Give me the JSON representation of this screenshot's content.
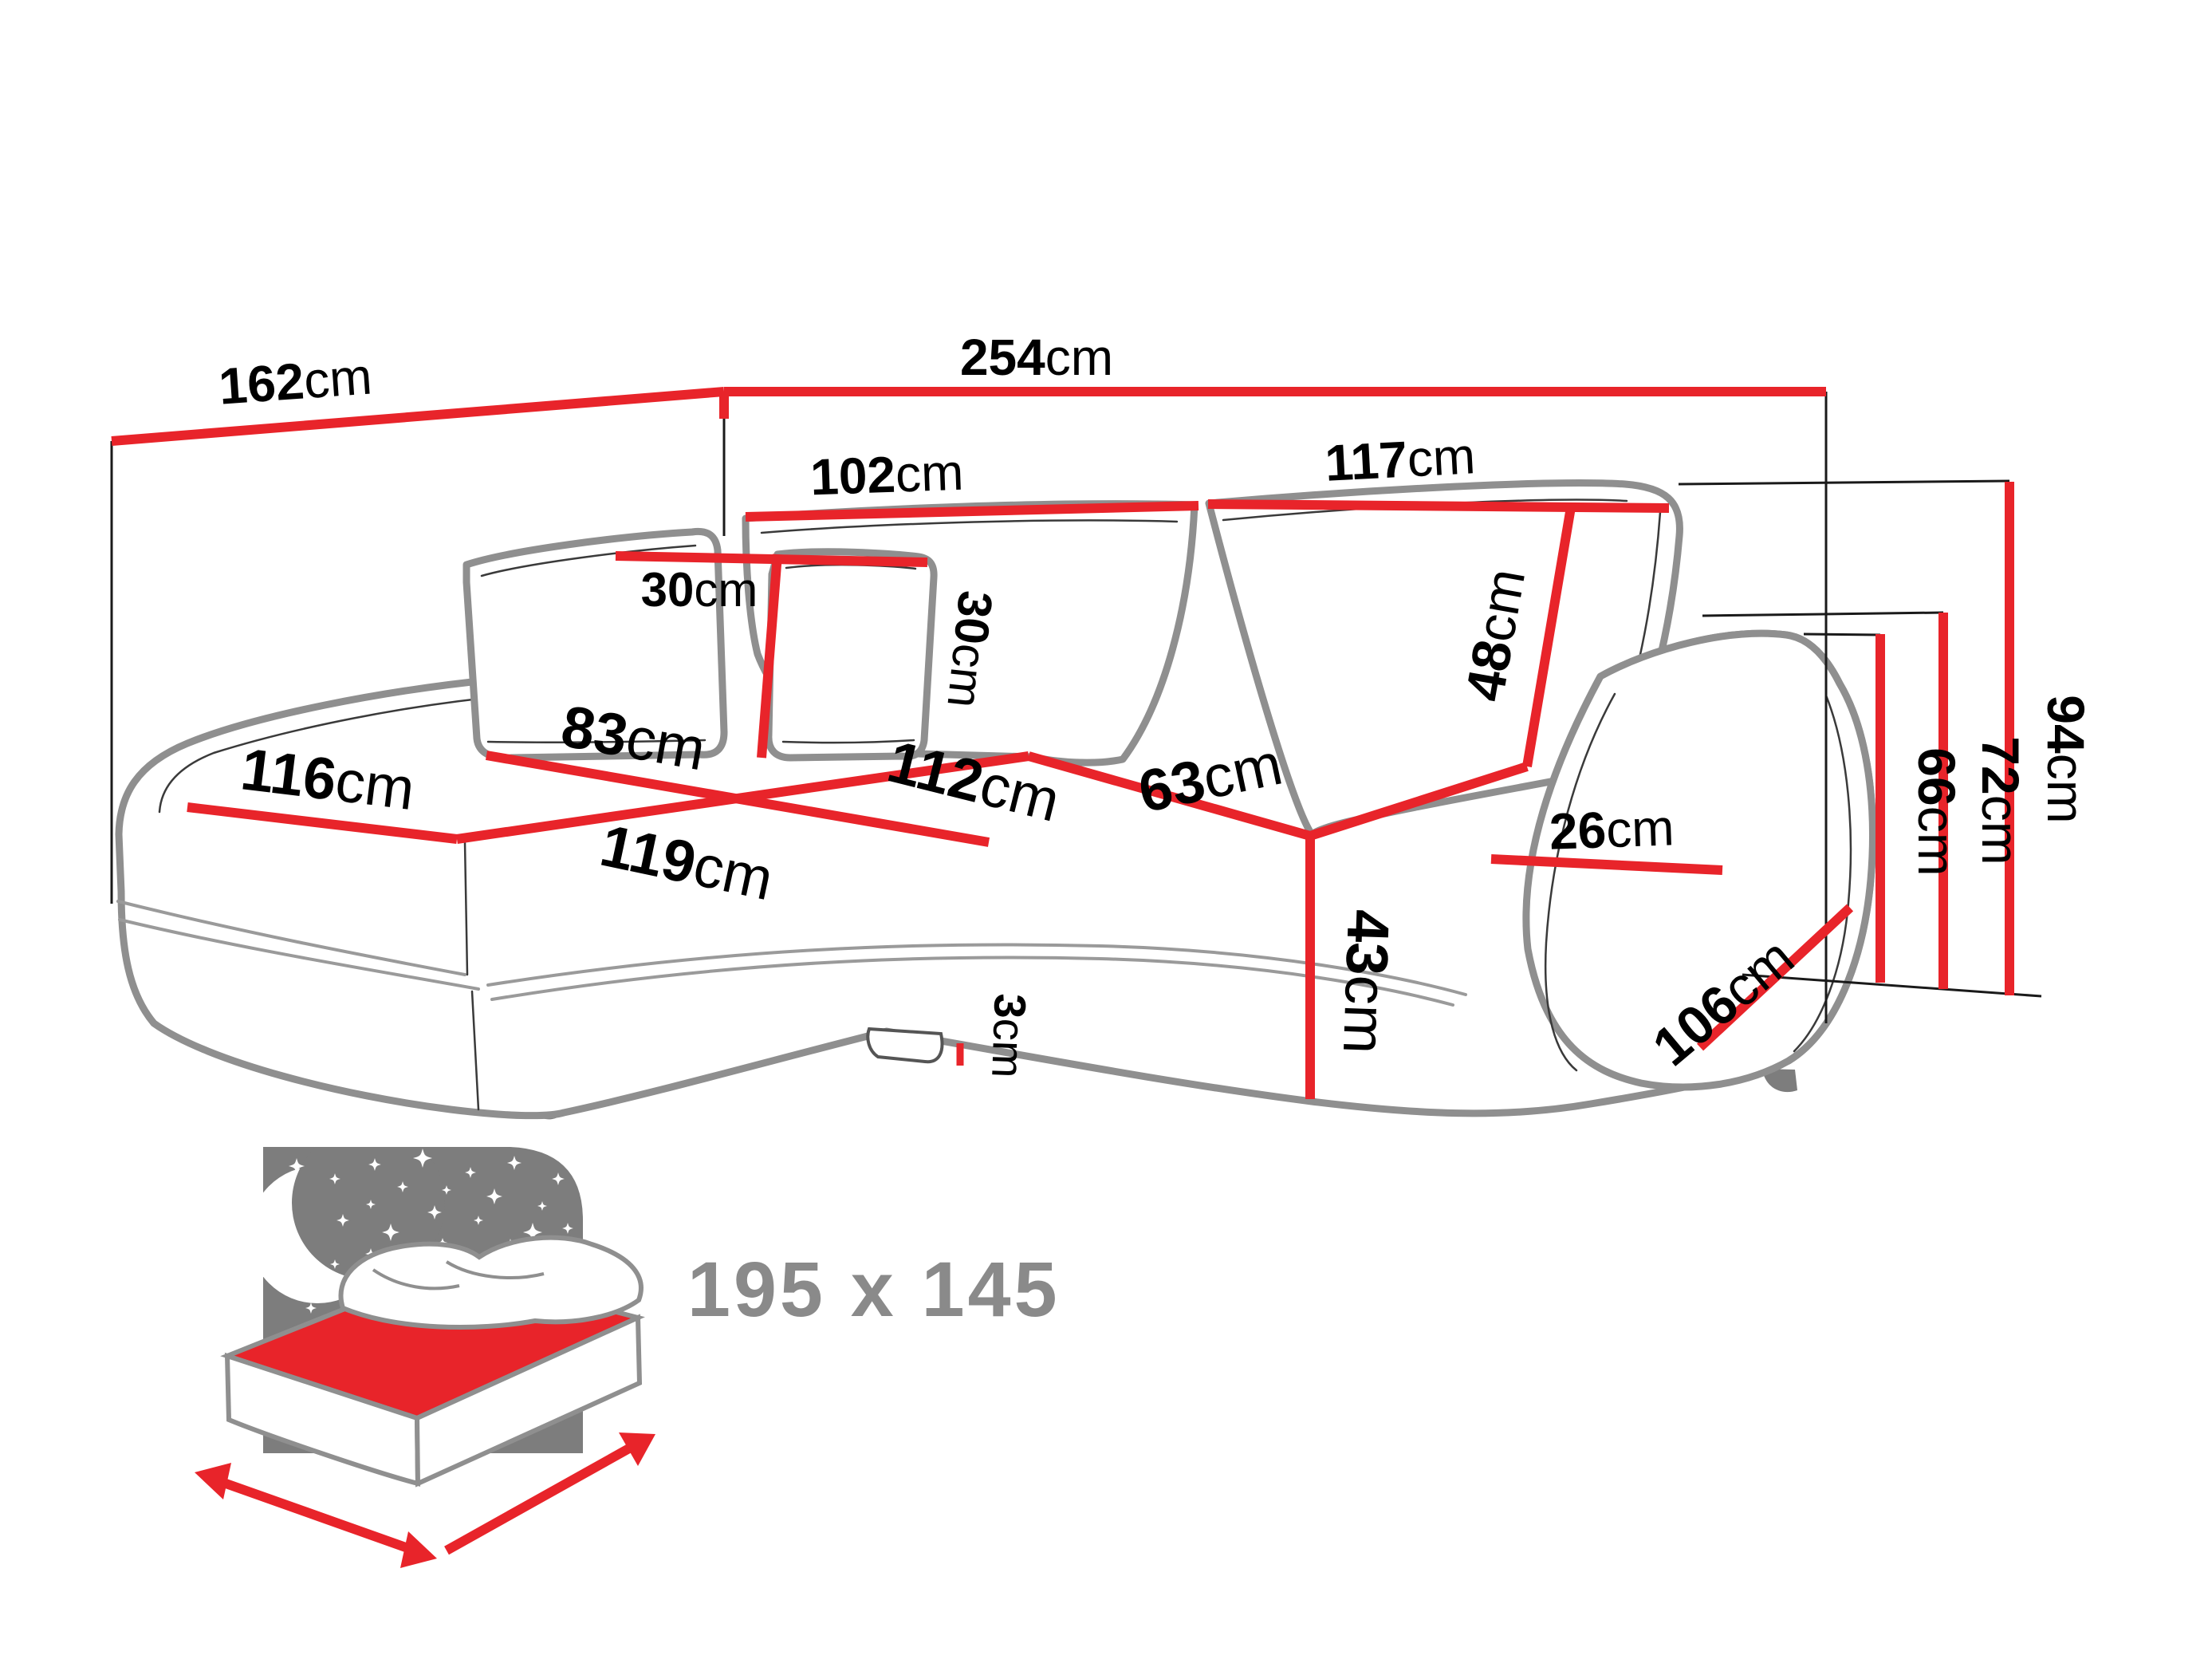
{
  "dimensions": {
    "wall_left": {
      "value": "162",
      "unit": "cm"
    },
    "wall_top": {
      "value": "254",
      "unit": "cm"
    },
    "backrest_left": {
      "value": "102",
      "unit": "cm"
    },
    "backrest_right": {
      "value": "117",
      "unit": "cm"
    },
    "pillow_width": {
      "value": "30",
      "unit": "cm"
    },
    "pillow_height": {
      "value": "30",
      "unit": "cm"
    },
    "backrest_height": {
      "value": "48",
      "unit": "cm"
    },
    "chaise_depth": {
      "value": "83",
      "unit": "cm"
    },
    "chaise_width": {
      "value": "116",
      "unit": "cm"
    },
    "chaise_front": {
      "value": "119",
      "unit": "cm"
    },
    "seat_width": {
      "value": "112",
      "unit": "cm"
    },
    "seat_depth": {
      "value": "63",
      "unit": "cm"
    },
    "seat_height": {
      "value": "43",
      "unit": "cm"
    },
    "leg_height": {
      "value": "3",
      "unit": "cm"
    },
    "armrest_top": {
      "value": "26",
      "unit": "cm"
    },
    "armrest_front": {
      "value": "106",
      "unit": "cm"
    },
    "height_armrest": {
      "value": "66",
      "unit": "cm"
    },
    "height_backrest": {
      "value": "72",
      "unit": "cm"
    },
    "height_total": {
      "value": "94",
      "unit": "cm"
    }
  },
  "sleeping_area": {
    "label": "195 x 145"
  },
  "colors": {
    "measure_red": "#e8242a",
    "sofa_outline_gray": "#8f8f8f",
    "icon_panel_gray": "#7d7d7d",
    "sleeping_text_gray": "#8a8a8a",
    "label_black": "#000000"
  }
}
